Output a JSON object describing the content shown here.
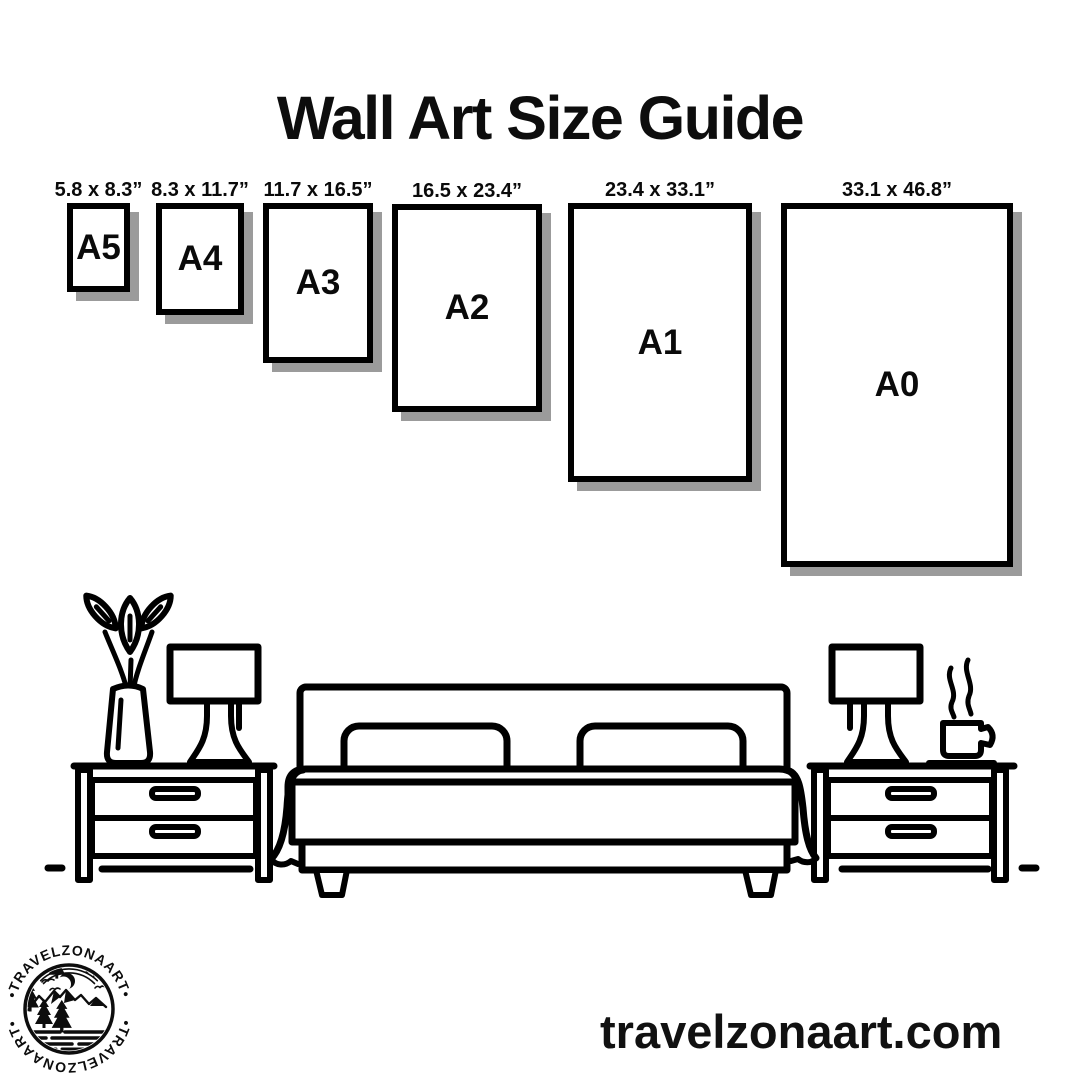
{
  "title": "Wall Art Size Guide",
  "sizes": [
    {
      "label": "A5",
      "dimensions": "5.8 x 8.3”"
    },
    {
      "label": "A4",
      "dimensions": "8.3 x 11.7”"
    },
    {
      "label": "A3",
      "dimensions": "11.7 x 16.5”"
    },
    {
      "label": "A2",
      "dimensions": "16.5 x 23.4”"
    },
    {
      "label": "A1",
      "dimensions": "23.4 x 33.1”"
    },
    {
      "label": "A0",
      "dimensions": "33.1 x 46.8”"
    }
  ],
  "illustration": {
    "icons": [
      "vase-with-plant-icon",
      "table-lamp-icon",
      "double-bed-icon",
      "nightstand-icon",
      "coffee-cup-steam-icon"
    ]
  },
  "logo": {
    "text_top": "•TRAVELZONAART•",
    "text_bottom": "•TRAVELZONAART•"
  },
  "website": "travelzonaart.com",
  "colors": {
    "ink": "#000000",
    "background": "#ffffff",
    "frame_shadow": "#9b9b9b"
  }
}
